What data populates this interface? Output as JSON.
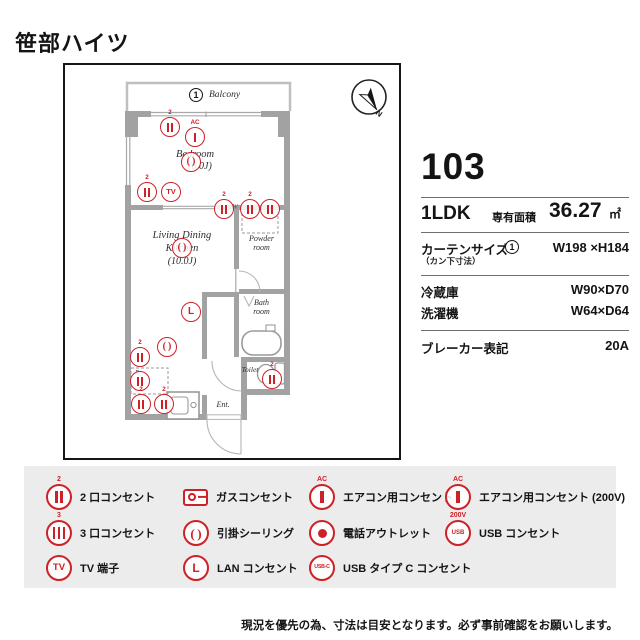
{
  "title": "笹部ハイツ",
  "plan": {
    "balcony": {
      "num": "1",
      "label": "Balcony"
    },
    "compass_n": "N",
    "labels": {
      "bedroom_name": "Bedroom",
      "bedroom_size": "(6.0J)",
      "ldk_line1": "Living Dining",
      "ldk_line2": "Kitchen",
      "ldk_size": "(10.0J)",
      "powder_line1": "Powder",
      "powder_line2": "room",
      "bath_line1": "Bath",
      "bath_line2": "room",
      "toilet": "Toilet",
      "entrance": "Ent.",
      "washer_spot": "W",
      "fridge_spot": "R"
    },
    "icons": [
      {
        "t": "o2",
        "x": 105,
        "y": 62,
        "tag": "2"
      },
      {
        "t": "ac",
        "x": 130,
        "y": 72,
        "tag": "AC"
      },
      {
        "t": "ceil",
        "x": 126,
        "y": 97
      },
      {
        "t": "o2",
        "x": 82,
        "y": 127,
        "tag": "2"
      },
      {
        "t": "tv",
        "x": 106,
        "y": 127
      },
      {
        "t": "o2",
        "x": 159,
        "y": 144,
        "tag": "2"
      },
      {
        "t": "o2",
        "x": 185,
        "y": 144,
        "tag": "2"
      },
      {
        "t": "o2",
        "x": 205,
        "y": 144
      },
      {
        "t": "ceil",
        "x": 117,
        "y": 183
      },
      {
        "t": "lan",
        "x": 126,
        "y": 247
      },
      {
        "t": "ceil",
        "x": 102,
        "y": 282
      },
      {
        "t": "o2",
        "x": 75,
        "y": 292,
        "tag": "2"
      },
      {
        "t": "o2",
        "x": 75,
        "y": 316
      },
      {
        "t": "o2",
        "x": 76,
        "y": 339,
        "tag": "2"
      },
      {
        "t": "o2",
        "x": 99,
        "y": 339,
        "tag": "2"
      },
      {
        "t": "o2",
        "x": 207,
        "y": 314,
        "tag": "2"
      }
    ]
  },
  "info": {
    "room_no": "103",
    "layout": "1LDK",
    "area_label": "専有面積",
    "area_value": "36.27",
    "area_unit": "㎡",
    "curtain_label": "カーテンサイズ",
    "curtain_note": "（カン下寸法）",
    "curtain_num": "1",
    "curtain_size": "W198 ×H184",
    "fridge_label": "冷蔵庫",
    "fridge_size": "W90×D70",
    "washer_label": "洗濯機",
    "washer_size": "W64×D64",
    "breaker_label": "ブレーカー表記",
    "breaker_value": "20A"
  },
  "legend": {
    "columns": [
      [
        {
          "t": "o2",
          "tag": "2",
          "label": "2 口コンセント"
        },
        {
          "t": "o3",
          "tag": "3",
          "label": "3 口コンセント"
        },
        {
          "t": "tv",
          "glyph": "TV",
          "label": "TV 端子"
        }
      ],
      [
        {
          "t": "gas",
          "label": "ガスコンセント"
        },
        {
          "t": "ceil",
          "label": "引掛シーリング"
        },
        {
          "t": "lan",
          "glyph": "L",
          "label": "LAN コンセント"
        }
      ],
      [
        {
          "t": "ac",
          "tag": "AC",
          "label": "エアコン用コンセント"
        },
        {
          "t": "phone",
          "label": "電話アウトレット"
        },
        {
          "t": "usbc",
          "glyph": "USB-C",
          "label": "USB タイプ C コンセント"
        }
      ],
      [
        {
          "t": "ac200",
          "tag": "AC",
          "tag2": "200V",
          "label": "エアコン用コンセント (200V)"
        },
        {
          "t": "usb",
          "glyph": "USB",
          "label": "USB コンセント"
        }
      ]
    ]
  },
  "disclaimer": "現況を優先の為、寸法は目安となります。必ず事前確認をお願いします。"
}
